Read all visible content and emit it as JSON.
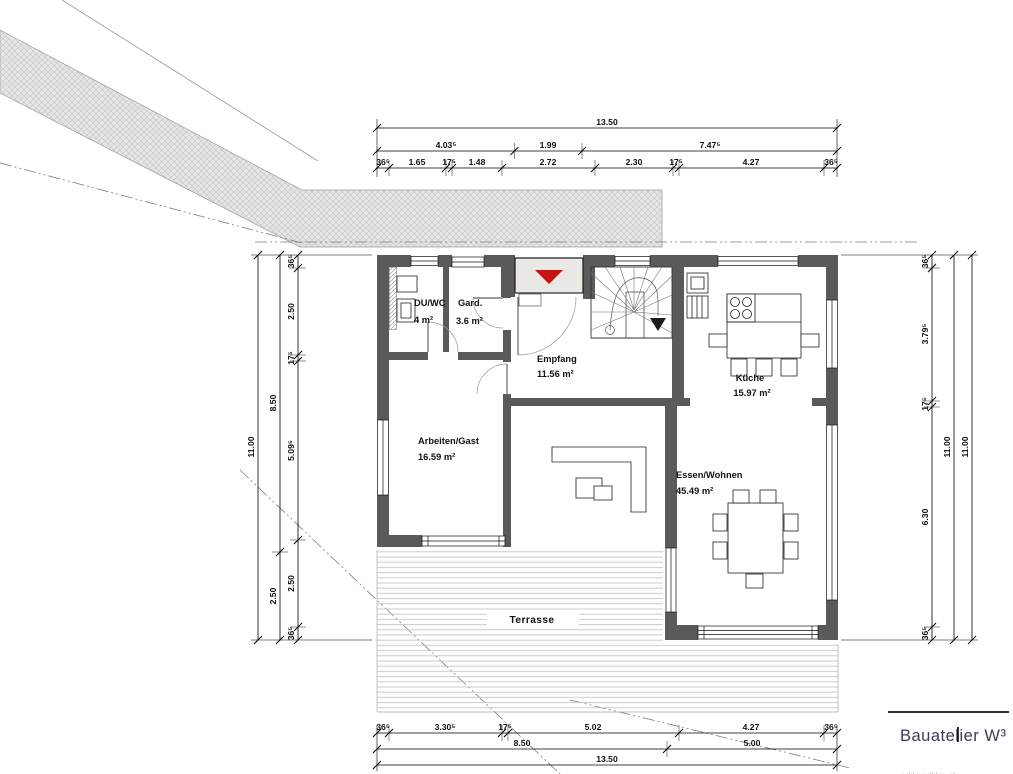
{
  "plan": {
    "rooms": {
      "duwc": {
        "name": "DU/WC",
        "area": "4 m²"
      },
      "gard": {
        "name": "Gard.",
        "area": "3.6 m²"
      },
      "empfang": {
        "name": "Empfang",
        "area": "11.56 m²"
      },
      "kueche": {
        "name": "Küche",
        "area": "15.97 m²"
      },
      "arbeiten": {
        "name": "Arbeiten/Gast",
        "area": "16.59 m²"
      },
      "essen": {
        "name": "Essen/Wohnen",
        "area": "45.49 m²"
      },
      "terrasse": {
        "name": "Terrasse"
      }
    }
  },
  "dims": {
    "top": {
      "total": "13.50",
      "mid": [
        "4.03⁵",
        "1.99",
        "7.47⁵"
      ],
      "detail": [
        "36⁵",
        "1.65",
        "17⁵",
        "1.48",
        "2.72",
        "2.30",
        "17⁵",
        "4.27",
        "36⁵"
      ]
    },
    "bottom": {
      "detail": [
        "36⁵",
        "3.30⁵",
        "17⁵",
        "5.02",
        "4.27",
        "36⁵"
      ],
      "mid": [
        "8.50",
        "5.00"
      ],
      "total": "13.50"
    },
    "left": {
      "detail": [
        "36⁵",
        "2.50",
        "17⁵",
        "5.09⁵",
        "2.50",
        "36⁵"
      ],
      "mid": [
        "8.50",
        "2.50"
      ],
      "total": "11.00"
    },
    "right": {
      "detail": [
        "36⁵",
        "3.79⁵",
        "17⁵",
        "6.30",
        "36⁵"
      ],
      "mid": "11.00",
      "total": "11.00"
    }
  },
  "logo": {
    "name": "Bauatelier W³",
    "tagline": "ı.ılıl.ı   ıı.ıllıl.ıı   ..ıl"
  },
  "colors": {
    "wall": "#5a5a5a",
    "entrance_arrow_red": "#c41414",
    "porch_fill": "#eae9e6",
    "hatch_fill": "#e6e6e4",
    "deck_line": "#c6c6c6",
    "logo_text": "#3c3c55"
  }
}
